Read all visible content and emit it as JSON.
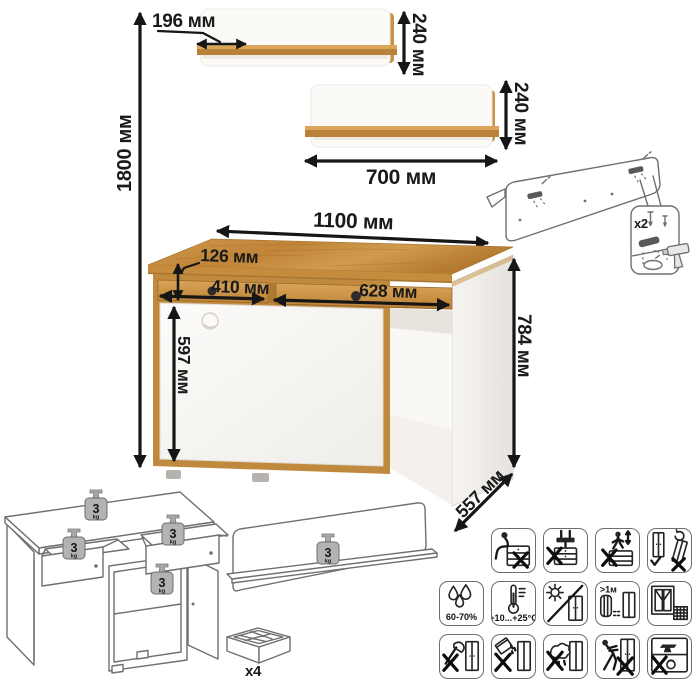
{
  "dimensions": {
    "total_height": "1800 мм",
    "shelf_depth": "196 мм",
    "shelf_top_height": "240 мм",
    "shelf_bottom_height": "240 мм",
    "shelf_width": "700 мм",
    "desk_width": "1100 мм",
    "drawer_front_height": "126 мм",
    "left_drawer_width": "410 мм",
    "right_drawer_width": "628 мм",
    "door_height": "597 мм",
    "desk_height": "784 мм",
    "desk_depth": "557 мм"
  },
  "counts": {
    "wall_fasteners": "x2",
    "packages": "x4"
  },
  "load_limit": {
    "value": "3",
    "unit": "kg"
  },
  "care_icons": [
    {
      "name": "no-sitting",
      "label": ""
    },
    {
      "name": "no-clamping",
      "label": ""
    },
    {
      "name": "no-standing",
      "label": ""
    },
    {
      "name": "carry-upright-only",
      "label": ""
    },
    {
      "name": "humidity-range",
      "label": "60-70%"
    },
    {
      "name": "temperature-range",
      "label": "+10...+25°C"
    },
    {
      "name": "no-direct-sunlight",
      "label": ""
    },
    {
      "name": "heat-source-distance",
      "label": ">1м"
    },
    {
      "name": "ventilated-room",
      "label": ""
    },
    {
      "name": "no-sharp-tools",
      "label": ""
    },
    {
      "name": "no-pouring-liquids",
      "label": ""
    },
    {
      "name": "no-wet-cloth",
      "label": ""
    },
    {
      "name": "no-pushing",
      "label": ""
    },
    {
      "name": "no-overloading",
      "label": ""
    }
  ],
  "colors": {
    "oak": "#c68f42",
    "oak_dark": "#a9762f",
    "panel_white": "#f8f6f3",
    "line_art": "#6f6f6f",
    "dimension_ink": "#1a1a1a"
  }
}
